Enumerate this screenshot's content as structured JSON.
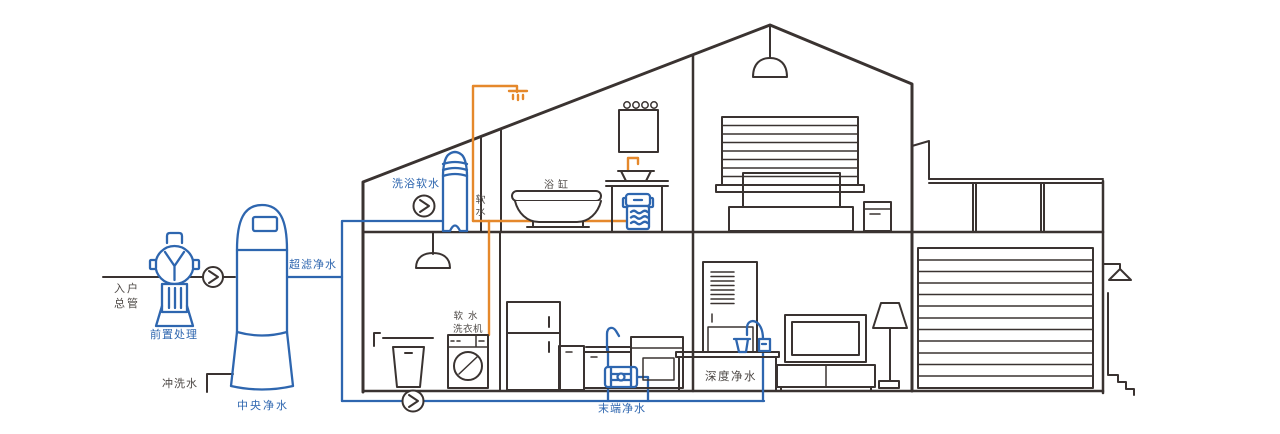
{
  "diagram": {
    "colors": {
      "blue": "#2e66af",
      "orange": "#e5882b",
      "line": "#3a3331",
      "text_dark": "#4d4845"
    },
    "labels": {
      "inlet_line1": "入户",
      "inlet_line2": "总管",
      "prefilter": "前置处理",
      "central": "中央净水",
      "flush": "冲洗水",
      "ultrafiltration": "超滤净水",
      "bath_softener": "洗浴软水",
      "soft_water": "软水",
      "bathtub": "浴缸",
      "washer_line1": "软水",
      "washer_line2": "洗衣机",
      "terminal": "末端净水",
      "deep": "深度净水"
    }
  }
}
